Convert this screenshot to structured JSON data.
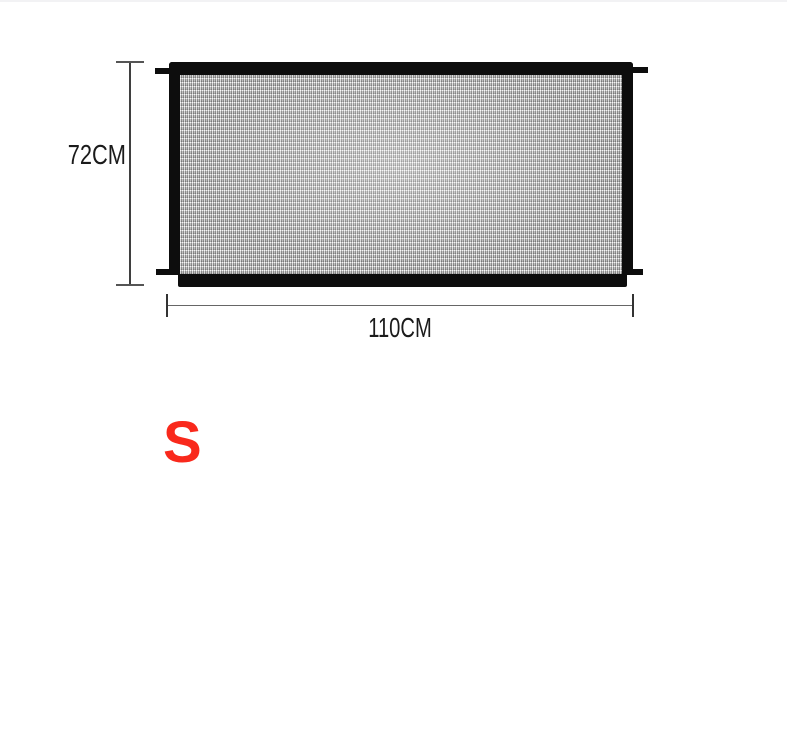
{
  "diagram": {
    "height_label": "72CM",
    "width_label": "110CM",
    "size_badge": "S",
    "colors": {
      "frame": "#0d0d0d",
      "mesh": "#b5b5b5",
      "dimension_line": "#555555",
      "dimension_text": "#1b1b1b",
      "size_badge_text": "#f9291c",
      "background": "#ffffff"
    }
  }
}
